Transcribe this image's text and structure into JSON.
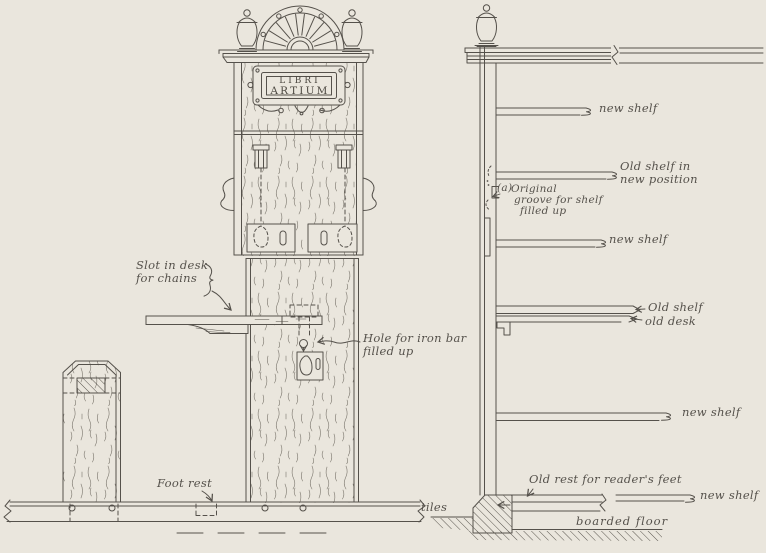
{
  "figure": {
    "background_color": "#eae6dd",
    "ink_color": "#55514b",
    "left_view": {
      "plate_line1": "LIBRI",
      "plate_line2": "ARTIUM",
      "slot_line1": "Slot in desk",
      "slot_line2": "for chains",
      "hole_line1": "Hole for iron bar",
      "hole_line2": "filled up",
      "foot_rest": "Foot rest"
    },
    "right_view": {
      "new_shelf": "new shelf",
      "old_shelf_position_line1": "Old shelf in",
      "old_shelf_position_line2": "new position",
      "groove_marker": "(a)",
      "groove_line1": "Original",
      "groove_line2": "groove for shelf",
      "groove_line3": "filled up",
      "old_shelf": "Old shelf",
      "old_desk": "old desk",
      "old_rest": "Old rest for reader's feet",
      "tiles": "tiles",
      "boarded_floor": "boarded floor"
    }
  }
}
